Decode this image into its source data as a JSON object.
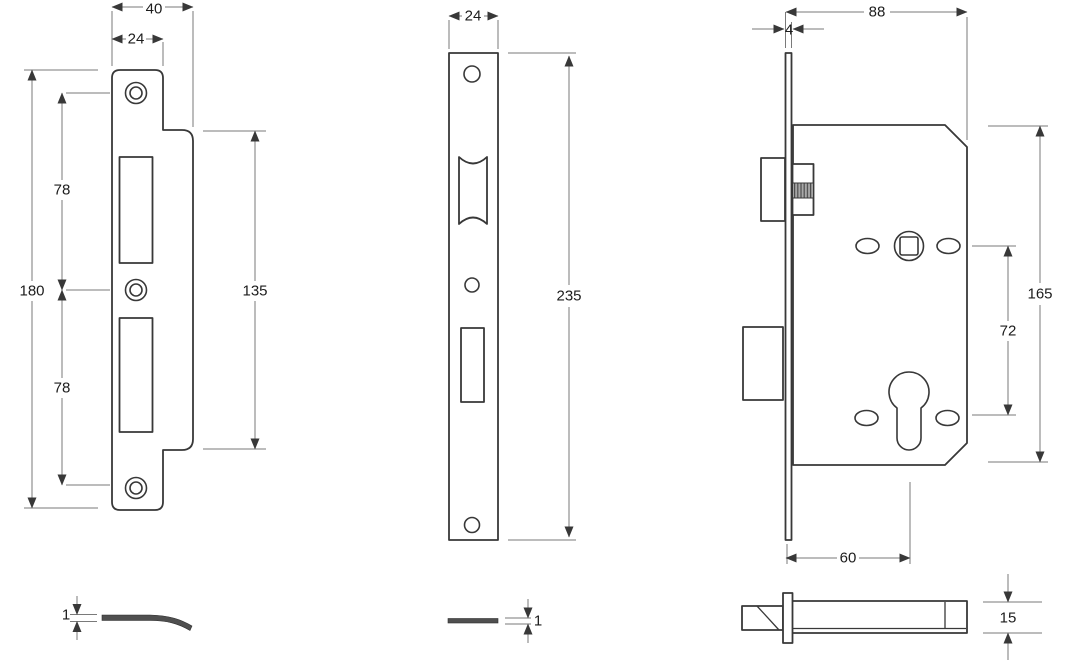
{
  "drawing": {
    "type": "mortice-lock-technical-drawing",
    "background": "#ffffff",
    "line_color": "#383838",
    "dim_line_color": "#7a7a7a",
    "text_color": "#1c1c1c",
    "hatch_color": "#9a9a9a",
    "views": {
      "strike_plate_front": {
        "dims": {
          "overall_width": "40",
          "face_width": "24",
          "upper_hole_centres": "78",
          "overall_height": "180",
          "lower_hole_centres": "78",
          "body_height": "135"
        }
      },
      "faceplate_front": {
        "dims": {
          "width": "24",
          "height": "235"
        }
      },
      "lock_case_side": {
        "dims": {
          "case_depth": "88",
          "faceplate_thickness": "4",
          "case_height": "165",
          "centres": "72",
          "backset": "60"
        }
      },
      "lock_case_bottom": {
        "dims": {
          "case_thickness": "15"
        }
      },
      "strike_plate_side": {
        "dims": {
          "thickness": "1"
        }
      },
      "faceplate_side": {
        "dims": {
          "thickness": "1"
        }
      }
    }
  }
}
